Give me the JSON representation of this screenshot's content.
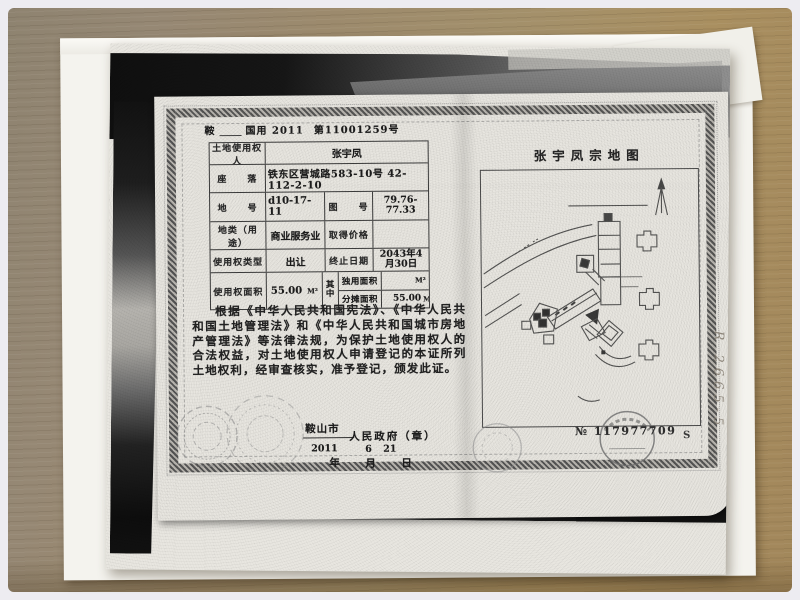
{
  "colors": {
    "desk_wood": "#9c8a68",
    "paper": "#f4f3ee",
    "photocopy_paper": "#e8e6e0",
    "scan_background": "#141414",
    "ink": "#1c1c1c"
  },
  "certificate": {
    "doc_no": {
      "prefix": "鞍",
      "series": "国用 2011",
      "number": "第11001259号"
    },
    "fields": {
      "holder_label": "土地使用权人",
      "holder": "张宇凤",
      "location_label": "座　　落",
      "location": "铁东区营城路583-10号  42-112-2-10",
      "plot_no_label": "地　　号",
      "plot_no": "d10-17-11",
      "map_no_label": "图　　号",
      "map_no": "79.76-77.33",
      "land_use_label": "地类（用途）",
      "land_use": "商业服务业",
      "price_label": "取得价格",
      "price": "",
      "right_type_label": "使用权类型",
      "right_type": "出让",
      "end_date_label": "终止日期",
      "end_date": "2043年4月30日",
      "area_label": "使用权面积",
      "area": "55.00",
      "area_unit": "M²",
      "of_which": "其中",
      "exclusive_area_label": "独用面积",
      "exclusive_area": "",
      "exclusive_area_unit": "M²",
      "shared_area_label": "分摊面积",
      "shared_area": "55.00",
      "shared_area_unit": "M²"
    },
    "legal_text": "根据《中华人民共和国宪法》、《中华人民共和国土地管理法》和《中华人民共和国城市房地产管理法》等法律法规，为保护土地使用权人的合法权益，对土地使用权人申请登记的本证所列土地权利，经审查核实，准予登记，颁发此证。",
    "issuer": {
      "city": "鞍山市",
      "government": "人民政府（章）",
      "year": "2011",
      "month": "6",
      "day": "21",
      "year_label": "年",
      "month_label": "月",
      "day_label": "日"
    }
  },
  "parcel_map_page": {
    "title": "张宇凤宗地图",
    "serial_prefix": "№",
    "serial_number": "117977709",
    "serial_suffix": "S"
  },
  "annotations": {
    "handwriting": "R 2665-5"
  }
}
